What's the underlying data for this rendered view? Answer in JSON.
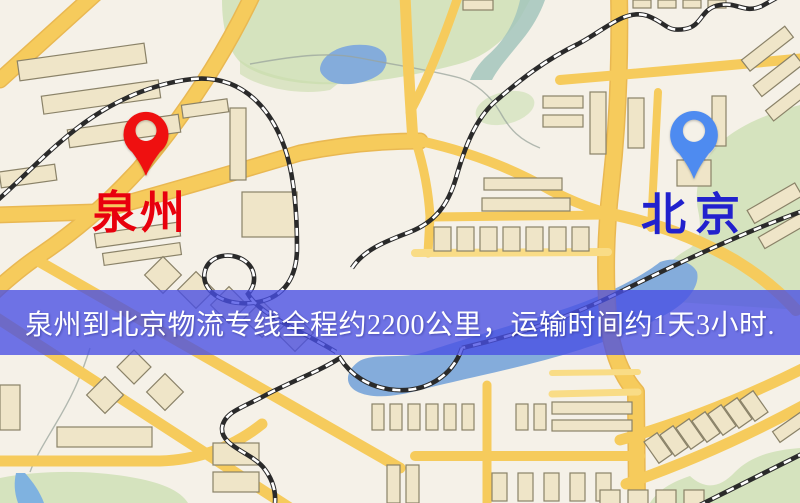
{
  "map": {
    "origin": {
      "name": "泉州",
      "pin_color": "#ef1010",
      "label_color": "#e8000d"
    },
    "destination": {
      "name": "北京",
      "pin_color": "#4e8bf0",
      "label_color": "#2121cd"
    },
    "banner": {
      "text": "泉州到北京物流专线全程约2200公里，运输时间约1天3小时.",
      "background": "rgba(72,78,228,0.78)",
      "text_color": "#ffffff",
      "route_distance": "约2200公里",
      "route_duration": "约1天3小时"
    }
  },
  "colors": {
    "land": "#f5f1e8",
    "road": "#f6cb5c",
    "road_casing": "#e9b852",
    "water": "#84acdb",
    "park": "#d5e3be",
    "railway": "#2a2a2a",
    "building": "#efe5c8",
    "building_outline": "#8a8268"
  }
}
